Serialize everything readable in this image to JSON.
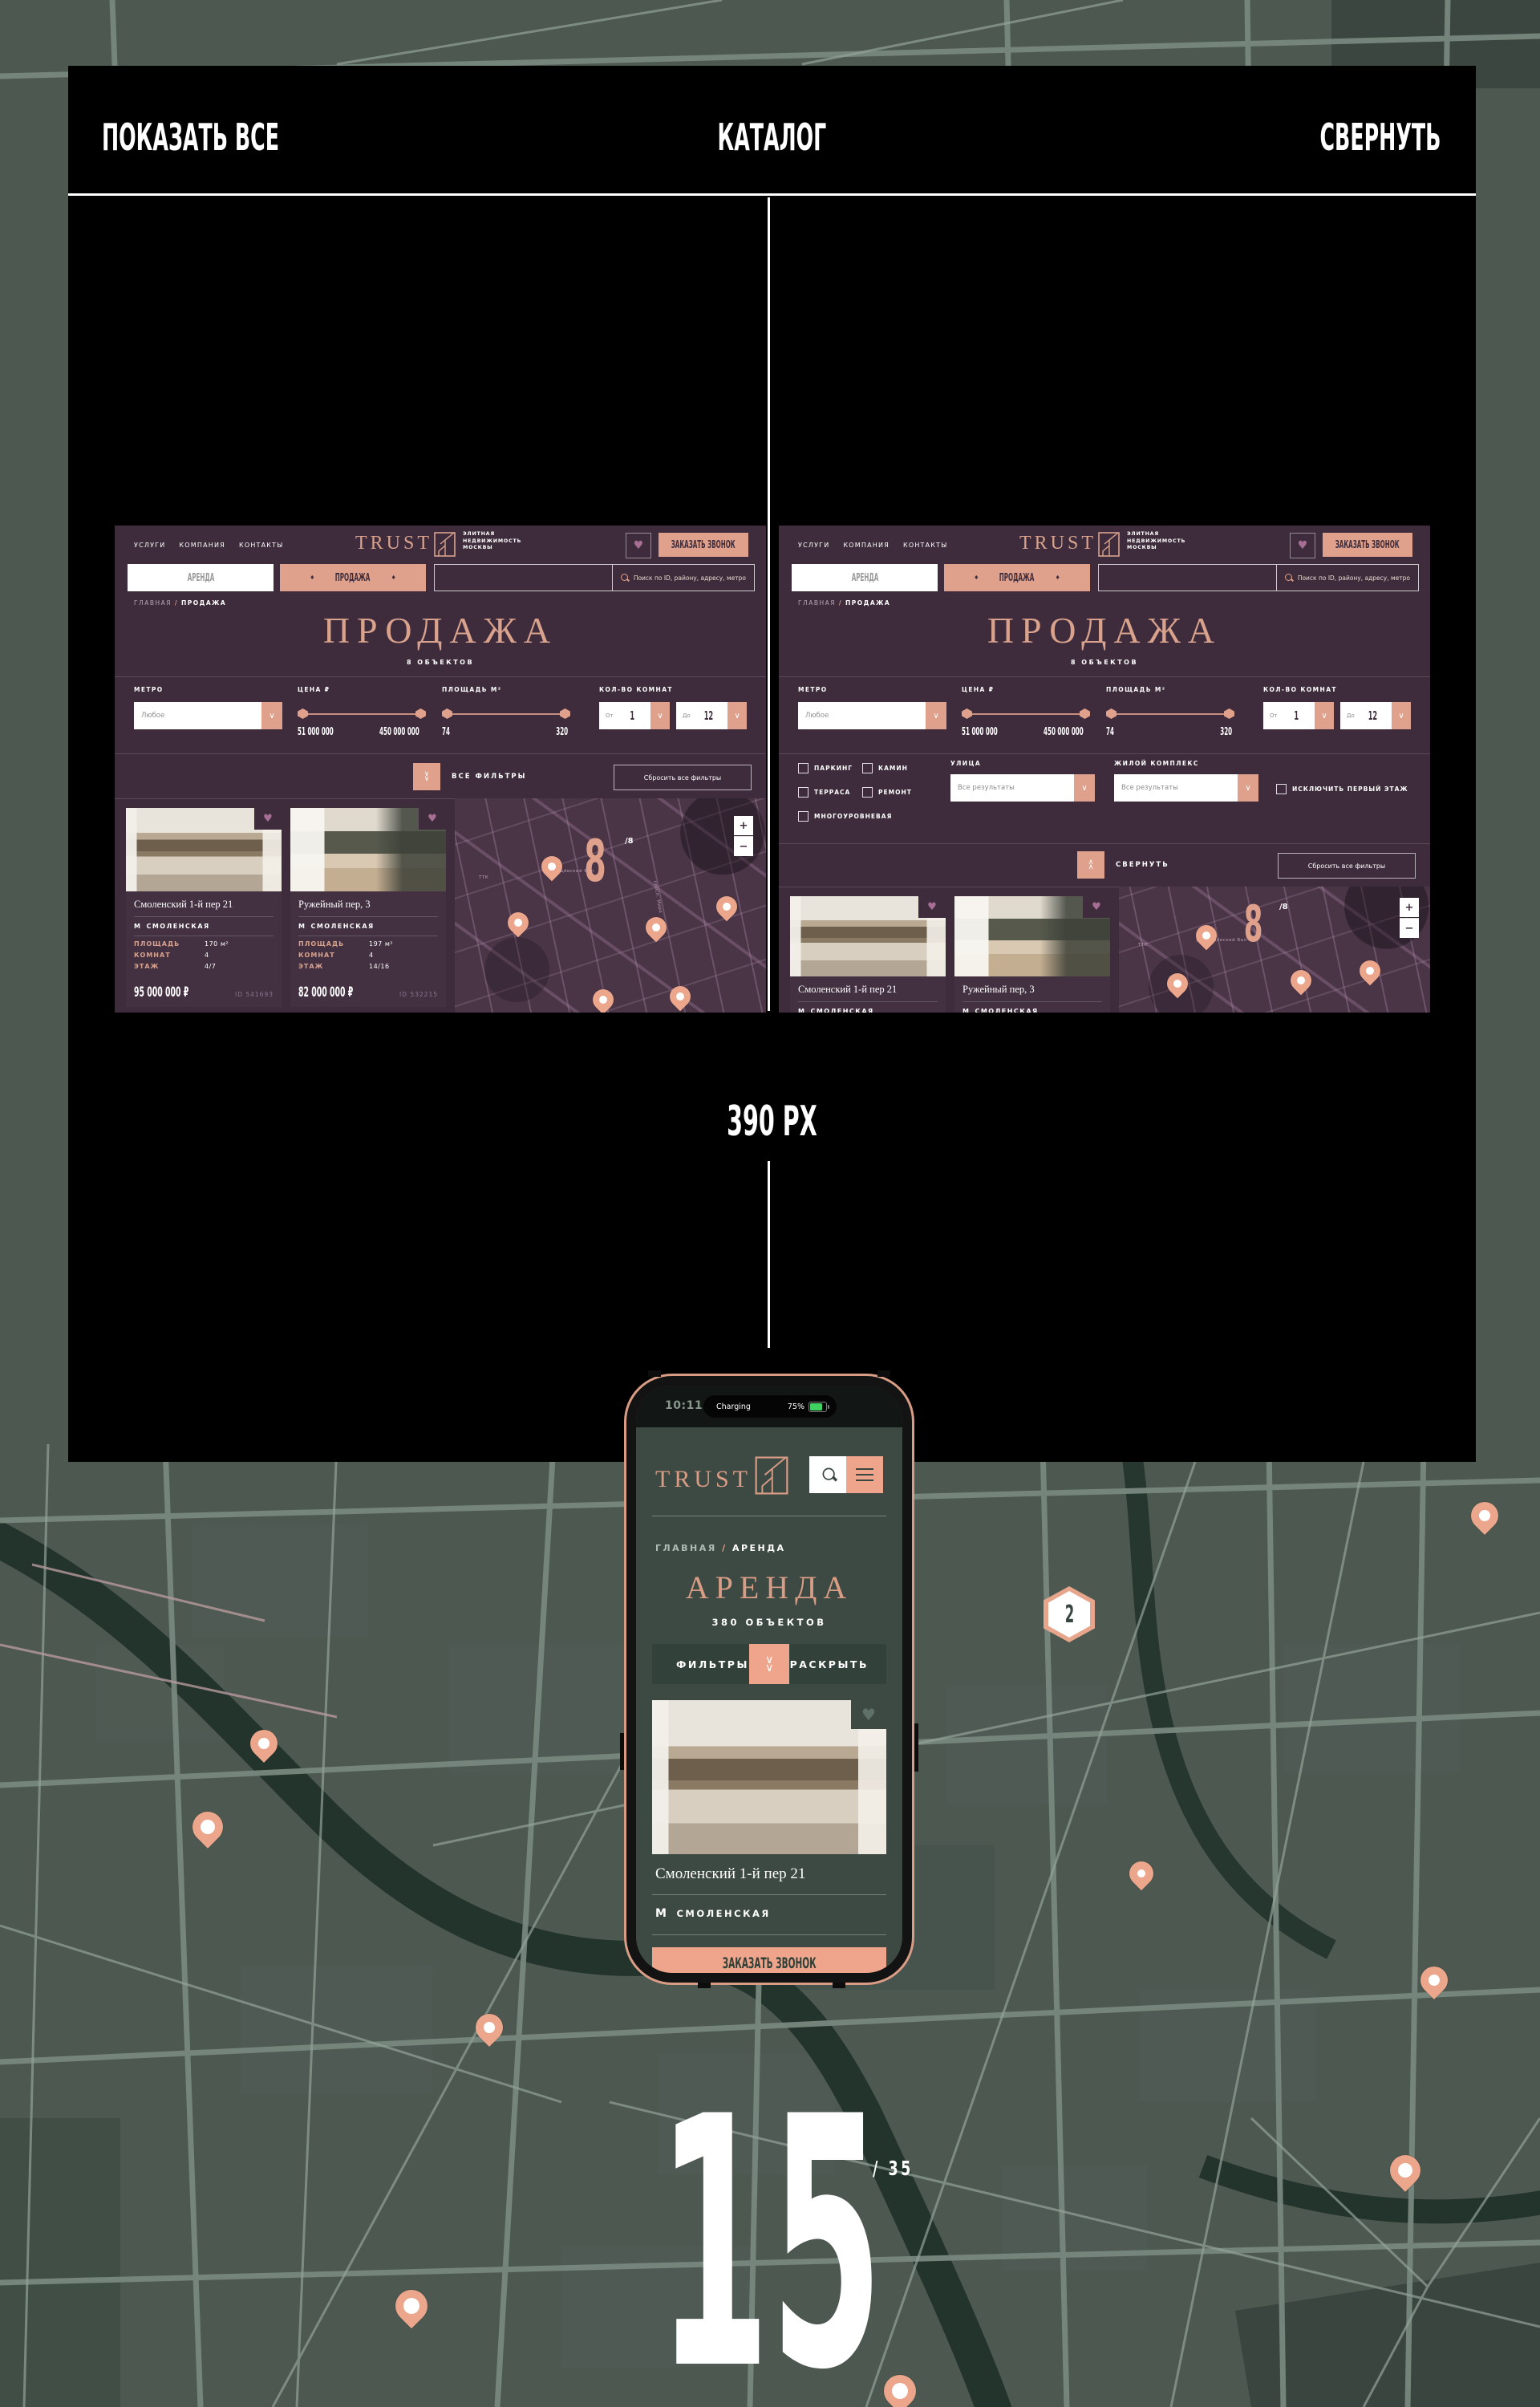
{
  "frame": {
    "show_all": "ПОКАЗАТЬ ВСЕ",
    "title": "КАТАЛОГ",
    "collapse": "СВЕРНУТЬ",
    "width_label": "390 PX",
    "page_number": "15",
    "page_total": "/ 35"
  },
  "icons": {
    "chevron_down": "∨",
    "chevron_up": "∧",
    "heart": "♥",
    "diamond": "♦",
    "plus": "+",
    "minus": "−",
    "metro": "М",
    "slash": "/"
  },
  "site": {
    "nav": [
      "УСЛУГИ",
      "КОМПАНИЯ",
      "КОНТАКТЫ"
    ],
    "brand": "TRUST",
    "tagline": [
      "ЭЛИТНАЯ",
      "НЕДВИЖИМОСТЬ",
      "МОСКВЫ"
    ],
    "call_button": "ЗАКАЗАТЬ ЗВОНОК",
    "tabs": {
      "arenda": "АРЕНДА",
      "prodazha": "ПРОДАЖА"
    },
    "search_placeholder": "Поиск по ID, району, адресу, метро",
    "breadcrumb": {
      "home": "ГЛАВНАЯ",
      "current": "ПРОДАЖА"
    },
    "title": "ПРОДАЖА",
    "objects_count": "8 ОБЪЕКТОВ",
    "filters": {
      "metro_label": "МЕТРО",
      "metro_value": "Любое",
      "price_label": "ЦЕНА ₽",
      "price_min": "51 000 000",
      "price_max": "450 000 000",
      "area_label": "ПЛОЩАДЬ М²",
      "area_min": "74",
      "area_max": "320",
      "rooms_label": "КОЛ-ВО КОМНАТ",
      "from_label": "От",
      "from_value": "1",
      "to_label": "До",
      "to_value": "12",
      "all_filters": "ВСЕ ФИЛЬТРЫ",
      "collapse": "СВЕРНУТЬ",
      "reset": "Сбросить все фильтры",
      "cb_parking": "ПАРКИНГ",
      "cb_fireplace": "КАМИН",
      "cb_terrace": "ТЕРРАСА",
      "cb_renovation": "РЕМОНТ",
      "cb_multilevel": "МНОГОУРОВНЕВАЯ",
      "street_label": "УЛИЦА",
      "street_value": "Все результаты",
      "complex_label": "ЖИЛОЙ КОМПЛЕКС",
      "complex_value": "Все результаты",
      "exclude_first_floor": "ИСКЛЮЧИТЬ ПЕРВЫЙ ЭТАЖ"
    },
    "map": {
      "count": "8",
      "total": "/8",
      "zoom_in": "+",
      "zoom_out": "−",
      "streets": [
        "ТТК",
        "ул. Сущёвский Вал",
        "просп. Мира"
      ]
    },
    "cards": [
      {
        "title": "Смоленский 1-й пер 21",
        "metro": "СМОЛЕНСКАЯ",
        "area_label": "ПЛОЩАДЬ",
        "area": "170 м²",
        "rooms_label": "КОМНАТ",
        "rooms": "4",
        "floor_label": "ЭТАЖ",
        "floor": "4/7",
        "price": "95 000 000 ₽",
        "id": "ID 541693"
      },
      {
        "title": "Ружейный пер, 3",
        "metro": "СМОЛЕНСКАЯ",
        "area_label": "ПЛОЩАДЬ",
        "area": "197 м²",
        "rooms_label": "КОМНАТ",
        "rooms": "4",
        "floor_label": "ЭТАЖ",
        "floor": "14/16",
        "price": "82 000 000 ₽",
        "id": "ID 532215"
      }
    ]
  },
  "mobile": {
    "time": "10:11",
    "island_status": "Charging",
    "battery": "75%",
    "brand": "TRUST",
    "breadcrumb": {
      "home": "ГЛАВНАЯ",
      "current": "АРЕНДА"
    },
    "title": "АРЕНДА",
    "objects_count": "380 ОБЪЕКТОВ",
    "filters_label": "ФИЛЬТРЫ",
    "expand_label": "РАСКРЫТЬ",
    "card": {
      "title": "Смоленский 1-й пер 21",
      "metro": "СМОЛЕНСКАЯ"
    },
    "call_button": "ЗАКАЗАТЬ ЗВОНОК"
  },
  "badge": {
    "count": "2"
  },
  "colors": {
    "accent": "#DFA18B",
    "site_bg": "#3E2C3C",
    "map_bg": "#4C5850",
    "metro_red": "#E2573B"
  }
}
